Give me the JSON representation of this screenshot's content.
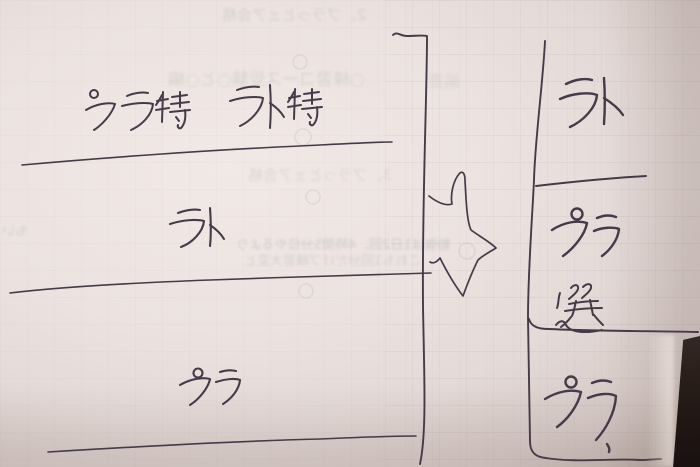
{
  "scene": {
    "description": "Photo of a handwritten study note on pinkish-white paper lying on a dark desk",
    "ink_color": "#453a47",
    "paper_color": "#ece3e0",
    "desk_color": "#241b18",
    "arrow_symbol": "⇨"
  },
  "left_column": {
    "rows": [
      {
        "text": "プラ特　ラト特"
      },
      {
        "text": "ラト"
      },
      {
        "text": "プラ"
      }
    ]
  },
  "right_column": {
    "rows": [
      {
        "text": "ラト"
      },
      {
        "text": "プラ"
      },
      {
        "text": "選"
      },
      {
        "text": "プラ"
      }
    ]
  },
  "show_through": {
    "g1": "2、プラっとェア合格",
    "g2": "○練習コース受験○と○編",
    "g2b": "編要",
    "g3": "3、プラっとェア合格",
    "g4": "勉強は1日2回、4時間5分位やるより",
    "g5": "これも1回分だけプ練習大変と",
    "g6": "もい"
  }
}
